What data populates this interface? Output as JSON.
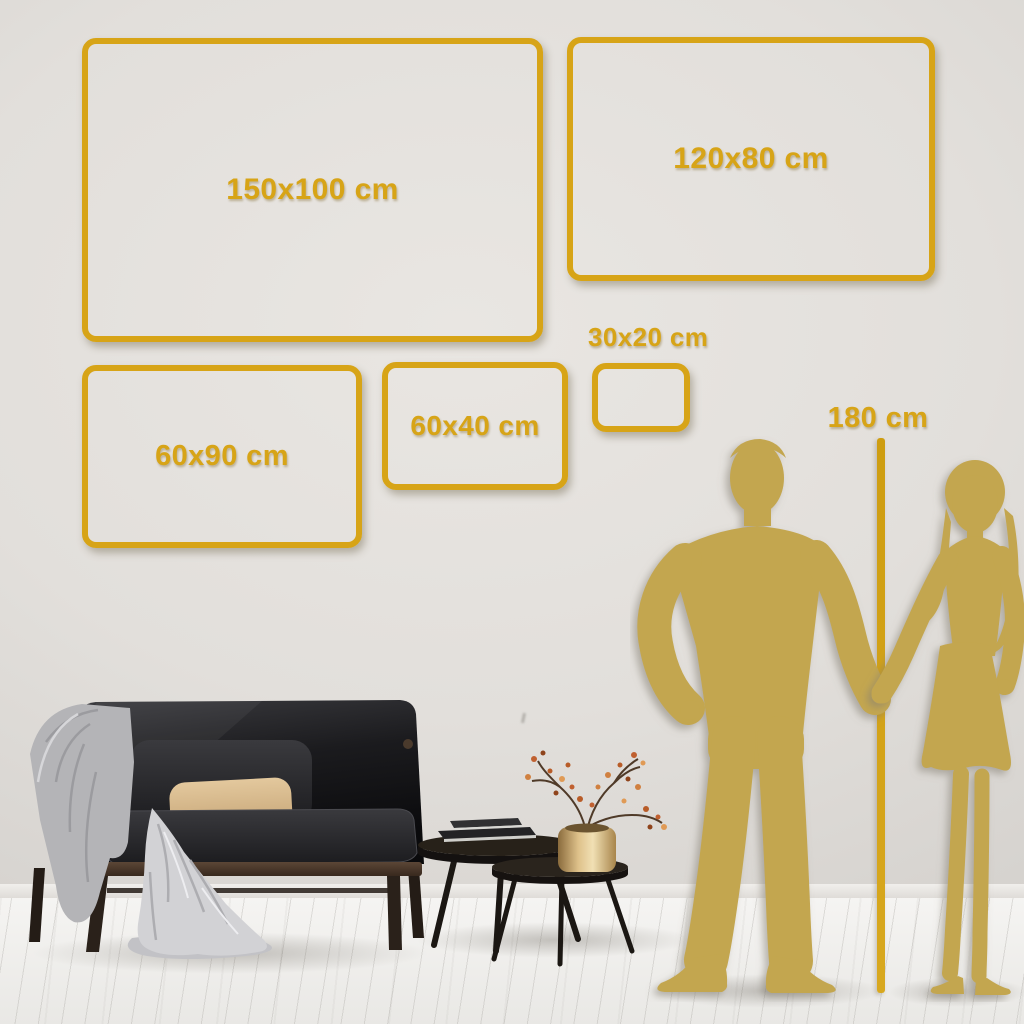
{
  "scene": {
    "description": "Canvas print size comparison on living-room wall",
    "colors": {
      "accent_gold": "#D7A417",
      "silhouette_gold": "#C3A64F",
      "wall": "#DDDAD6",
      "floor": "#F2F1EF"
    }
  },
  "size_boxes": [
    {
      "id": "150x100",
      "label": "150x100 cm"
    },
    {
      "id": "120x80",
      "label": "120x80 cm"
    },
    {
      "id": "60x90",
      "label": "60x90 cm"
    },
    {
      "id": "60x40",
      "label": "60x40 cm"
    },
    {
      "id": "30x20",
      "label": "30x20 cm"
    }
  ],
  "height_reference": {
    "label": "180 cm"
  },
  "illustrations": [
    "man-silhouette",
    "woman-silhouette",
    "sofa",
    "throw-blanket",
    "pillows",
    "nesting-coffee-tables",
    "books",
    "brass-vase",
    "dried-branch"
  ]
}
